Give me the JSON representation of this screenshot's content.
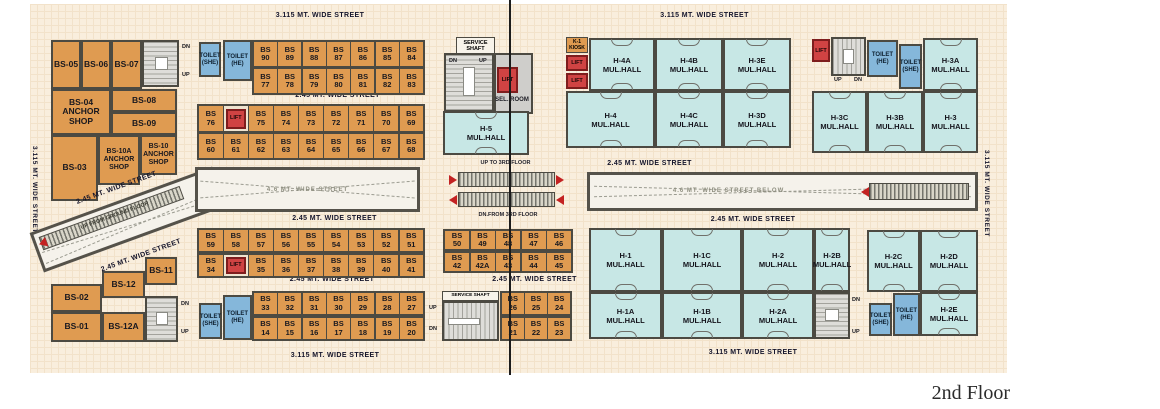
{
  "caption": "2nd Floor",
  "colors": {
    "shop": "#df9b51",
    "hall": "#c7e7e5",
    "toilet": "#85b7da",
    "lift": "#d04343",
    "wall": "#4c4a42",
    "bg": "#f9eedd"
  },
  "streets": {
    "top_left": "3.115  MT. WIDE STREET",
    "top_right": "3.115  MT. WIDE STREET",
    "left_v": "3.115  MT. WIDE STREET",
    "right_v": "3.115  MT. WIDE STREET",
    "a": "2.45 MT. WIDE  STREET",
    "b": "2.45 MT. WIDE  STREET",
    "c": "2.45 MT. WIDE  STREET",
    "d": "2.45 MT. WIDE STREET",
    "d2": "2.45 MT. WIDE STREET",
    "r1": "2.45 MT. WIDE  STREET",
    "r2": "2.45 MT. WIDE  STREET",
    "diag_top": "2.45 MT. WIDE  STREET",
    "diag_bot": "2.45 MT. WIDE  STREET",
    "bottom_left": "3.115  MT. WIDE STREET",
    "bottom_right": "3.115  MT. WIDE STREET"
  },
  "atrium": {
    "left": "4.6 MT. WIDE STREET",
    "right": "4.6 MT. WIDE STREET BELOW"
  },
  "esc": {
    "up3": "UP TO 3RD FLOOR",
    "dn3": "DN.FROM 3RD FLOOR",
    "upg": "UP FROM GROUND FLOOR"
  },
  "stairs": {
    "up": "UP",
    "dn": "DN"
  },
  "lift_label": "LIFT",
  "kiosk": "K-1\nKIOSK",
  "service": {
    "shaft": "SERVICE\nSHAFT",
    "shaft2": "SERVICE SHAFT",
    "sel": "SEL. ROOM"
  },
  "toilet": {
    "she": "TOILET\n(SHE)",
    "he": "TOILET\n(HE)"
  },
  "left_block": {
    "bs05": "BS-05",
    "bs06": "BS-06",
    "bs07": "BS-07",
    "bs04": "BS-04\nANCHOR\nSHOP",
    "bs08": "BS-08",
    "bs09": "BS-09",
    "bs03": "BS-03",
    "bs10a": "BS-10A\nANCHOR\nSHOP",
    "bs10": "BS-10\nANCHOR\nSHOP",
    "bs11": "BS-11",
    "bs12": "BS-12",
    "bs02": "BS-02",
    "bs01": "BS-01",
    "bs12a": "BS-12A"
  },
  "halls": {
    "h5": "H-5\nMUL.HALL",
    "h4a": "H-4A\nMUL.HALL",
    "h4b": "H-4B\nMUL.HALL",
    "h3e": "H-3E\nMUL.HALL",
    "h4": "H-4\nMUL.HALL",
    "h4c": "H-4C\nMUL.HALL",
    "h3d": "H-3D\nMUL.HALL",
    "h3a": "H-3A\nMUL.HALL",
    "h3c": "H-3C\nMUL.HALL",
    "h3b": "H-3B\nMUL.HALL",
    "h3": "H-3\nMUL.HALL",
    "h1": "H-1\nMUL.HALL",
    "h1c": "H-1C\nMUL.HALL",
    "h2": "H-2\nMUL.HALL",
    "h2b": "H-2B\nMUL.HALL",
    "h1a": "H-1A\nMUL.HALL",
    "h1b": "H-1B\nMUL.HALL",
    "h2a": "H-2A\nMUL.HALL",
    "h2c": "H-2C\nMUL.HALL",
    "h2d": "H-2D\nMUL.HALL",
    "h2e": "H-2E\nMUL.HALL"
  },
  "rows": {
    "a_top": [
      {
        "l": "BS\n90"
      },
      {
        "l": "BS\n89"
      },
      {
        "l": "BS\n88"
      },
      {
        "l": "BS\n87"
      },
      {
        "l": "BS\n86"
      },
      {
        "l": "BS\n85"
      },
      {
        "l": "BS\n84"
      }
    ],
    "a_bot": [
      {
        "l": "BS\n77"
      },
      {
        "l": "BS\n78"
      },
      {
        "l": "BS\n79"
      },
      {
        "l": "BS\n80"
      },
      {
        "l": "BS\n81"
      },
      {
        "l": "BS\n82"
      },
      {
        "l": "BS\n83"
      }
    ],
    "b_top": [
      {
        "l": "BS\n76"
      },
      {
        "l": "LIFT",
        "t": "lift"
      },
      {
        "l": "BS\n75"
      },
      {
        "l": "BS\n74"
      },
      {
        "l": "BS\n73"
      },
      {
        "l": "BS\n72"
      },
      {
        "l": "BS\n71"
      },
      {
        "l": "BS\n70"
      },
      {
        "l": "BS\n69"
      }
    ],
    "b_bot": [
      {
        "l": "BS\n60"
      },
      {
        "l": "BS\n61"
      },
      {
        "l": "BS\n62"
      },
      {
        "l": "BS\n63"
      },
      {
        "l": "BS\n64"
      },
      {
        "l": "BS\n65"
      },
      {
        "l": "BS\n66"
      },
      {
        "l": "BS\n67"
      },
      {
        "l": "BS\n68"
      }
    ],
    "c_top": [
      {
        "l": "BS\n59"
      },
      {
        "l": "BS\n58"
      },
      {
        "l": "BS\n57"
      },
      {
        "l": "BS\n56"
      },
      {
        "l": "BS\n55"
      },
      {
        "l": "BS\n54"
      },
      {
        "l": "BS\n53"
      },
      {
        "l": "BS\n52"
      },
      {
        "l": "BS\n51"
      }
    ],
    "c_bot": [
      {
        "l": "BS\n34"
      },
      {
        "l": "LIFT",
        "t": "lift"
      },
      {
        "l": "BS\n35"
      },
      {
        "l": "BS\n36"
      },
      {
        "l": "BS\n37"
      },
      {
        "l": "BS\n38"
      },
      {
        "l": "BS\n39"
      },
      {
        "l": "BS\n40"
      },
      {
        "l": "BS\n41"
      }
    ],
    "d_top": [
      {
        "l": "BS\n33"
      },
      {
        "l": "BS\n32"
      },
      {
        "l": "BS\n31"
      },
      {
        "l": "BS\n30"
      },
      {
        "l": "BS\n29"
      },
      {
        "l": "BS\n28"
      },
      {
        "l": "BS\n27"
      }
    ],
    "d_bot": [
      {
        "l": "BS\n14"
      },
      {
        "l": "BS\n15"
      },
      {
        "l": "BS\n16"
      },
      {
        "l": "BS\n17"
      },
      {
        "l": "BS\n18"
      },
      {
        "l": "BS\n19"
      },
      {
        "l": "BS\n20"
      }
    ],
    "ct_top": [
      {
        "l": "BS\n50"
      },
      {
        "l": "BS\n49"
      },
      {
        "l": "BS\n48"
      },
      {
        "l": "BS\n47"
      },
      {
        "l": "BS\n46"
      }
    ],
    "ct_bot": [
      {
        "l": "BS\n42"
      },
      {
        "l": "BS\n42A"
      },
      {
        "l": "BS\n43"
      },
      {
        "l": "BS\n44"
      },
      {
        "l": "BS\n45"
      }
    ],
    "e_top": [
      {
        "l": "BS\n26"
      },
      {
        "l": "BS\n25"
      },
      {
        "l": "BS\n24"
      }
    ],
    "e_bot": [
      {
        "l": "BS\n21"
      },
      {
        "l": "BS\n22"
      },
      {
        "l": "BS\n23"
      }
    ]
  }
}
